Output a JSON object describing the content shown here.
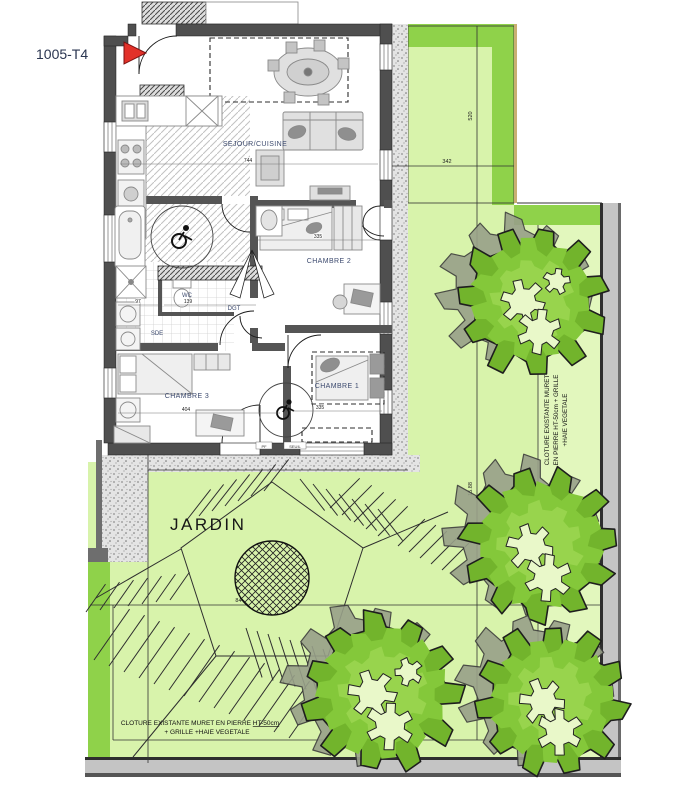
{
  "plan": {
    "unit_label": "1005-T4",
    "rooms": {
      "sejour": "SEJOUR/CUISINE",
      "chambre1": "CHAMBRE 1",
      "chambre2": "CHAMBRE 2",
      "chambre3": "CHAMBRE 3",
      "wc": "WC",
      "dgt": "DGT",
      "sde": "SDE"
    },
    "dimensions": {
      "sejour_width": "744",
      "chambre2_width": "335",
      "chambre1_width": "335",
      "chambre3_width": "404",
      "wc_width": "139",
      "sde_width": "97",
      "door_code_pf": "PF",
      "door_code_seuil": "SEUIL"
    }
  },
  "garden": {
    "label": "JARDIN",
    "dimensions": {
      "upper_width": "342",
      "upper_height": "520",
      "total_width": "844",
      "right_height": "15.88"
    },
    "fence_note_bottom": {
      "line1_prefix": "CLOTURE EXISTANTE MURET EN PIERRE ",
      "line1_underlined": "HT-50cm",
      "line2": "+ GRILLE +HAIE VEGETALE"
    },
    "fence_note_right": {
      "line1": "CLOTURE EXISTANTE MURET",
      "line2": "EN PIERRE HT-50cm + GRILLE",
      "line3": "+HAIE VEGETALE"
    }
  },
  "colors": {
    "garden_light": "#d8f3ab",
    "garden_dark": "#8fd24a",
    "tree_green": "#72b42c",
    "marker_red": "#e23129",
    "wall_dark": "#4f4f4f"
  }
}
